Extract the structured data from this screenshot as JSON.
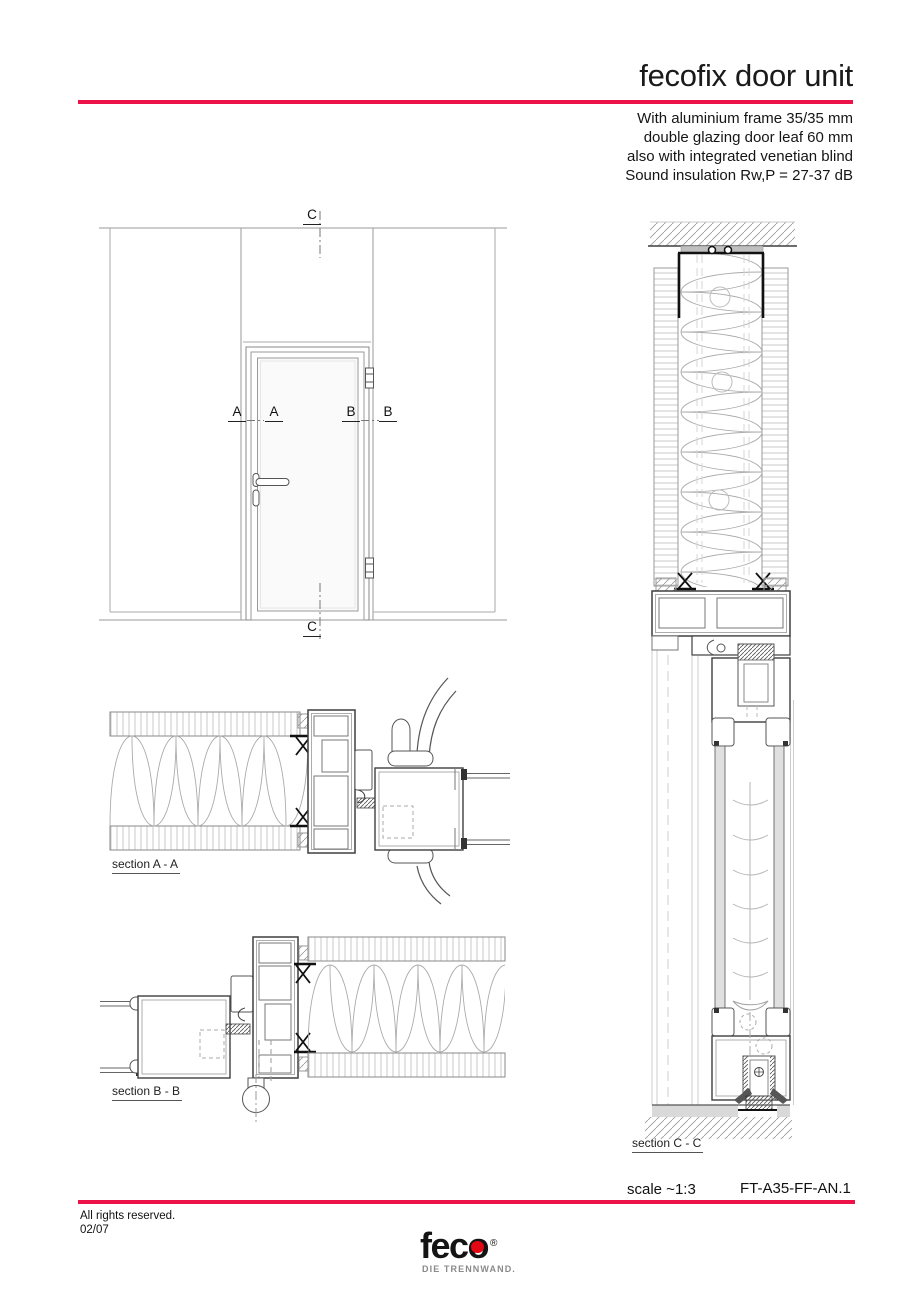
{
  "header": {
    "title": "fecofix door unit",
    "subtitle_lines": [
      "With aluminium frame 35/35 mm",
      "double glazing door leaf 60 mm",
      "also with integrated venetian blind",
      "Sound insulation Rw,P = 27-37 dB"
    ]
  },
  "drawing": {
    "markers": {
      "c_top": "C",
      "c_bottom": "C",
      "a_left": "A",
      "a_right": "A",
      "b_left": "B",
      "b_right": "B"
    },
    "section_labels": {
      "a": "section A - A",
      "b": "section B - B",
      "c": "section C - C"
    }
  },
  "footer": {
    "scale_label": "scale ~1:3",
    "drawing_number": "FT-A35-FF-AN.1",
    "rights": "All rights reserved.",
    "date": "02/07",
    "logo": {
      "text": "feco",
      "reg": "®",
      "tagline": "DIE TRENNWAND."
    }
  },
  "colors": {
    "accent_red": "#ed1248",
    "logo_red": "#e30613"
  }
}
